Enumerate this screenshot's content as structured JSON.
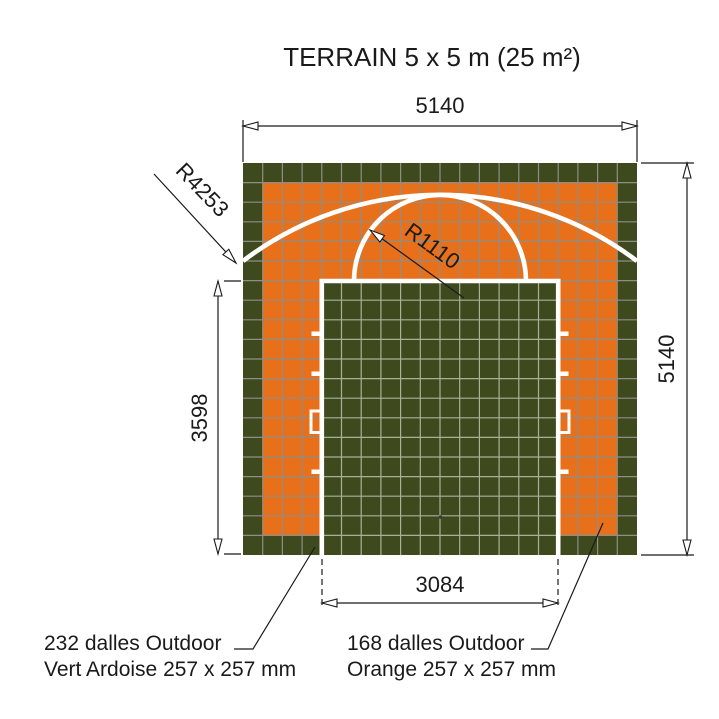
{
  "title": "TERRAIN 5 x 5 m (25 m²)",
  "dimensions": {
    "top_width_mm": "5140",
    "right_height_mm": "5140",
    "key_height_mm": "3598",
    "key_width_mm": "3084"
  },
  "radius_annotations": {
    "three_point_radius": "R4253",
    "free_throw_radius": "R1110"
  },
  "tile_callouts": {
    "green": {
      "line1": "232 dalles Outdoor",
      "line2": "Vert Ardoise 257 x 257 mm"
    },
    "orange": {
      "line1": "168 dalles Outdoor",
      "line2": "Orange 257 x 257 mm"
    }
  },
  "colors": {
    "court_green": "#3E4A1D",
    "court_orange": "#E8701A",
    "tile_grid_line": "#8F8D85",
    "key_tile_grid_line": "#A7B199",
    "court_marking_white": "#FFFFFF",
    "drawing_line": "#1A1A1A",
    "background": "#FFFFFF"
  }
}
